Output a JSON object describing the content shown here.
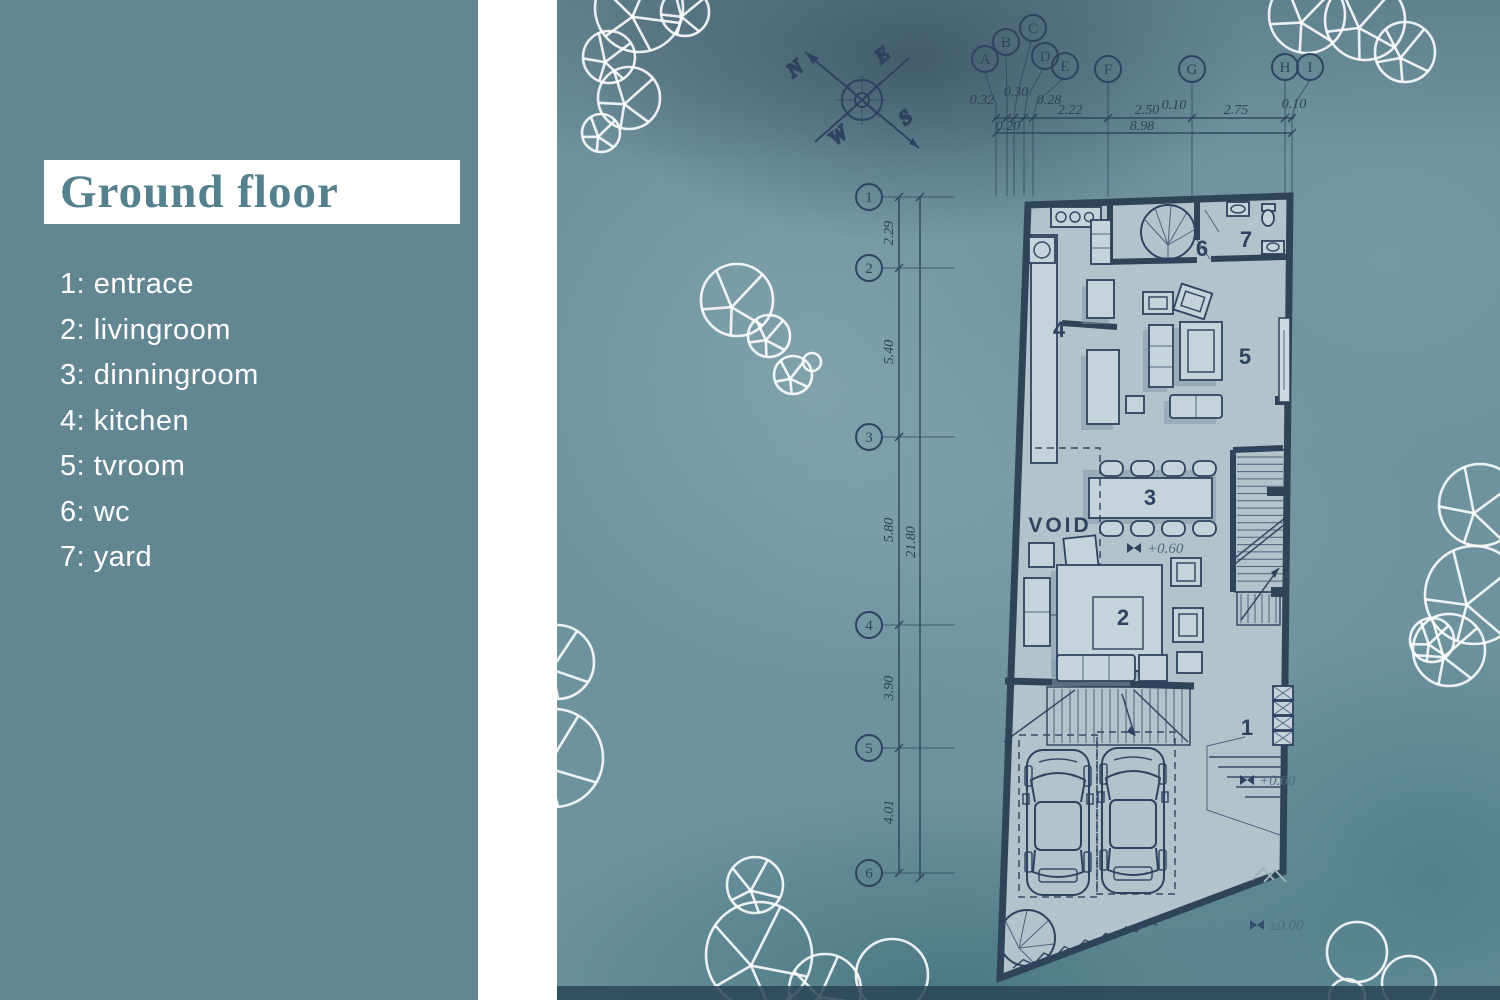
{
  "left_panel": {
    "title": "Ground floor",
    "legend": [
      "1: entrace",
      "2: livingroom",
      "3: dinningroom",
      "4: kitchen",
      "5: tvroom",
      "6: wc",
      "7: yard"
    ]
  },
  "compass": {
    "n": "N",
    "e": "E",
    "s": "S",
    "w": "W"
  },
  "top_grid": {
    "bubbles": [
      "A",
      "B",
      "C",
      "D",
      "E",
      "F",
      "G",
      "H",
      "I"
    ],
    "dims": {
      "ab": "0.32",
      "bc": "0.30",
      "cd": "0.28",
      "be": "0.20",
      "ef": "2.22",
      "fg": "2.50",
      "g0": "0.10",
      "gh": "2.75",
      "hi": "0.10",
      "total": "8.98"
    }
  },
  "left_grid": {
    "bubbles": [
      "1",
      "2",
      "3",
      "4",
      "5",
      "6"
    ],
    "dims": {
      "r12": "2.29",
      "r23": "5.40",
      "r34": "5.80",
      "r45": "3.90",
      "r56": "4.01",
      "total": "21.80"
    }
  },
  "plan": {
    "labels": {
      "entrance": "1",
      "livingroom": "2",
      "dinningroom": "3",
      "kitchen": "4",
      "tvroom": "5",
      "wc": "6",
      "yard": "7"
    },
    "void": "VOID",
    "levels": {
      "mid": "+0.60",
      "entry": "+0.60",
      "ground": "±0.00"
    }
  },
  "colors": {
    "panel": "#628692",
    "ink": "#2e4360",
    "plan_fill": "#b2c3cc",
    "band": "#ffffff"
  }
}
